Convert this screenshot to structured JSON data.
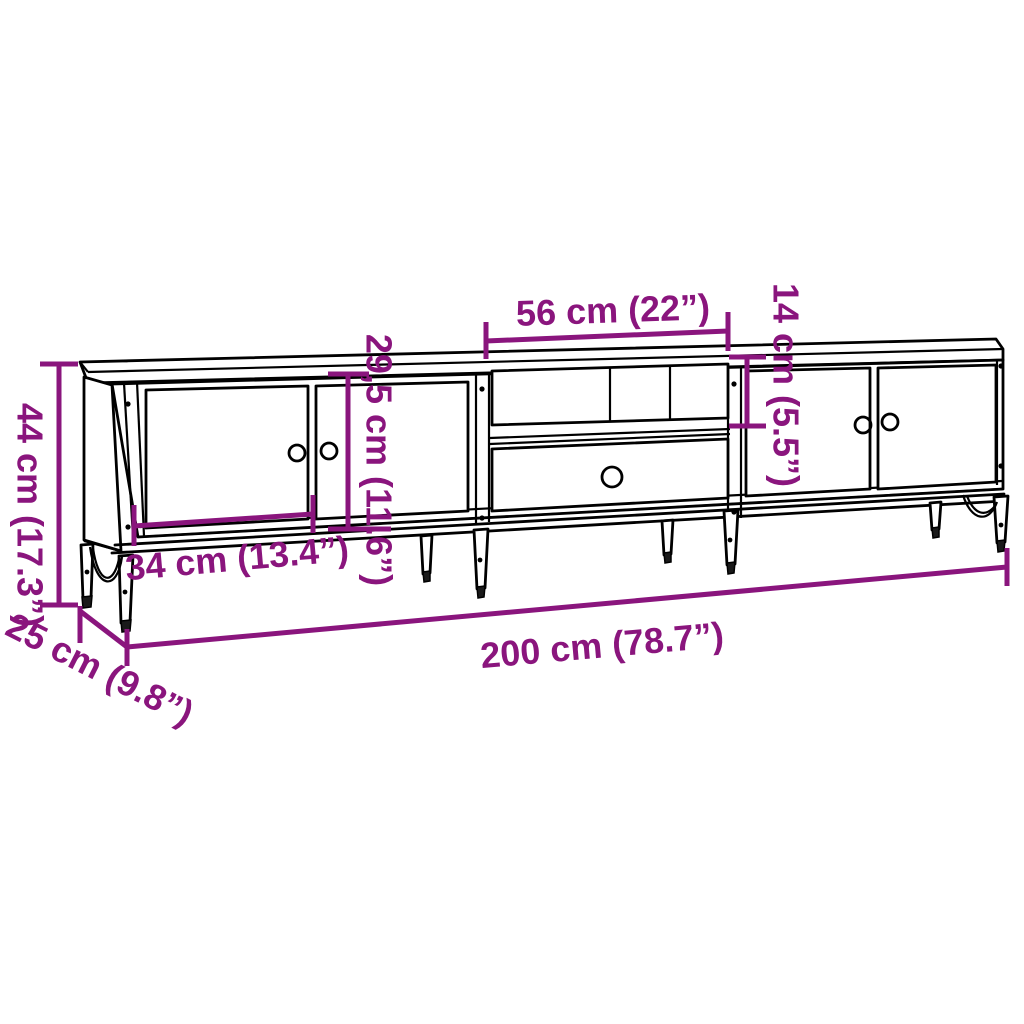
{
  "diagram": {
    "title": "TV cabinet dimensional line drawing",
    "background": "#FFFFFF",
    "outline_color": "#000000",
    "dimension_color": "#8A157D",
    "dimensions": {
      "overall_height": {
        "label": "44 cm (17.3”)"
      },
      "depth": {
        "label": "25 cm (9.8”)"
      },
      "overall_width": {
        "label": "200 cm (78.7”)"
      },
      "door_width": {
        "label": "34 cm (13.4”)"
      },
      "inner_height": {
        "label": "29,5 cm (11.6”)"
      },
      "shelf_width": {
        "label": "56 cm (22”)"
      },
      "shelf_opening_height": {
        "label": "14 cm (5.5”)"
      }
    }
  }
}
